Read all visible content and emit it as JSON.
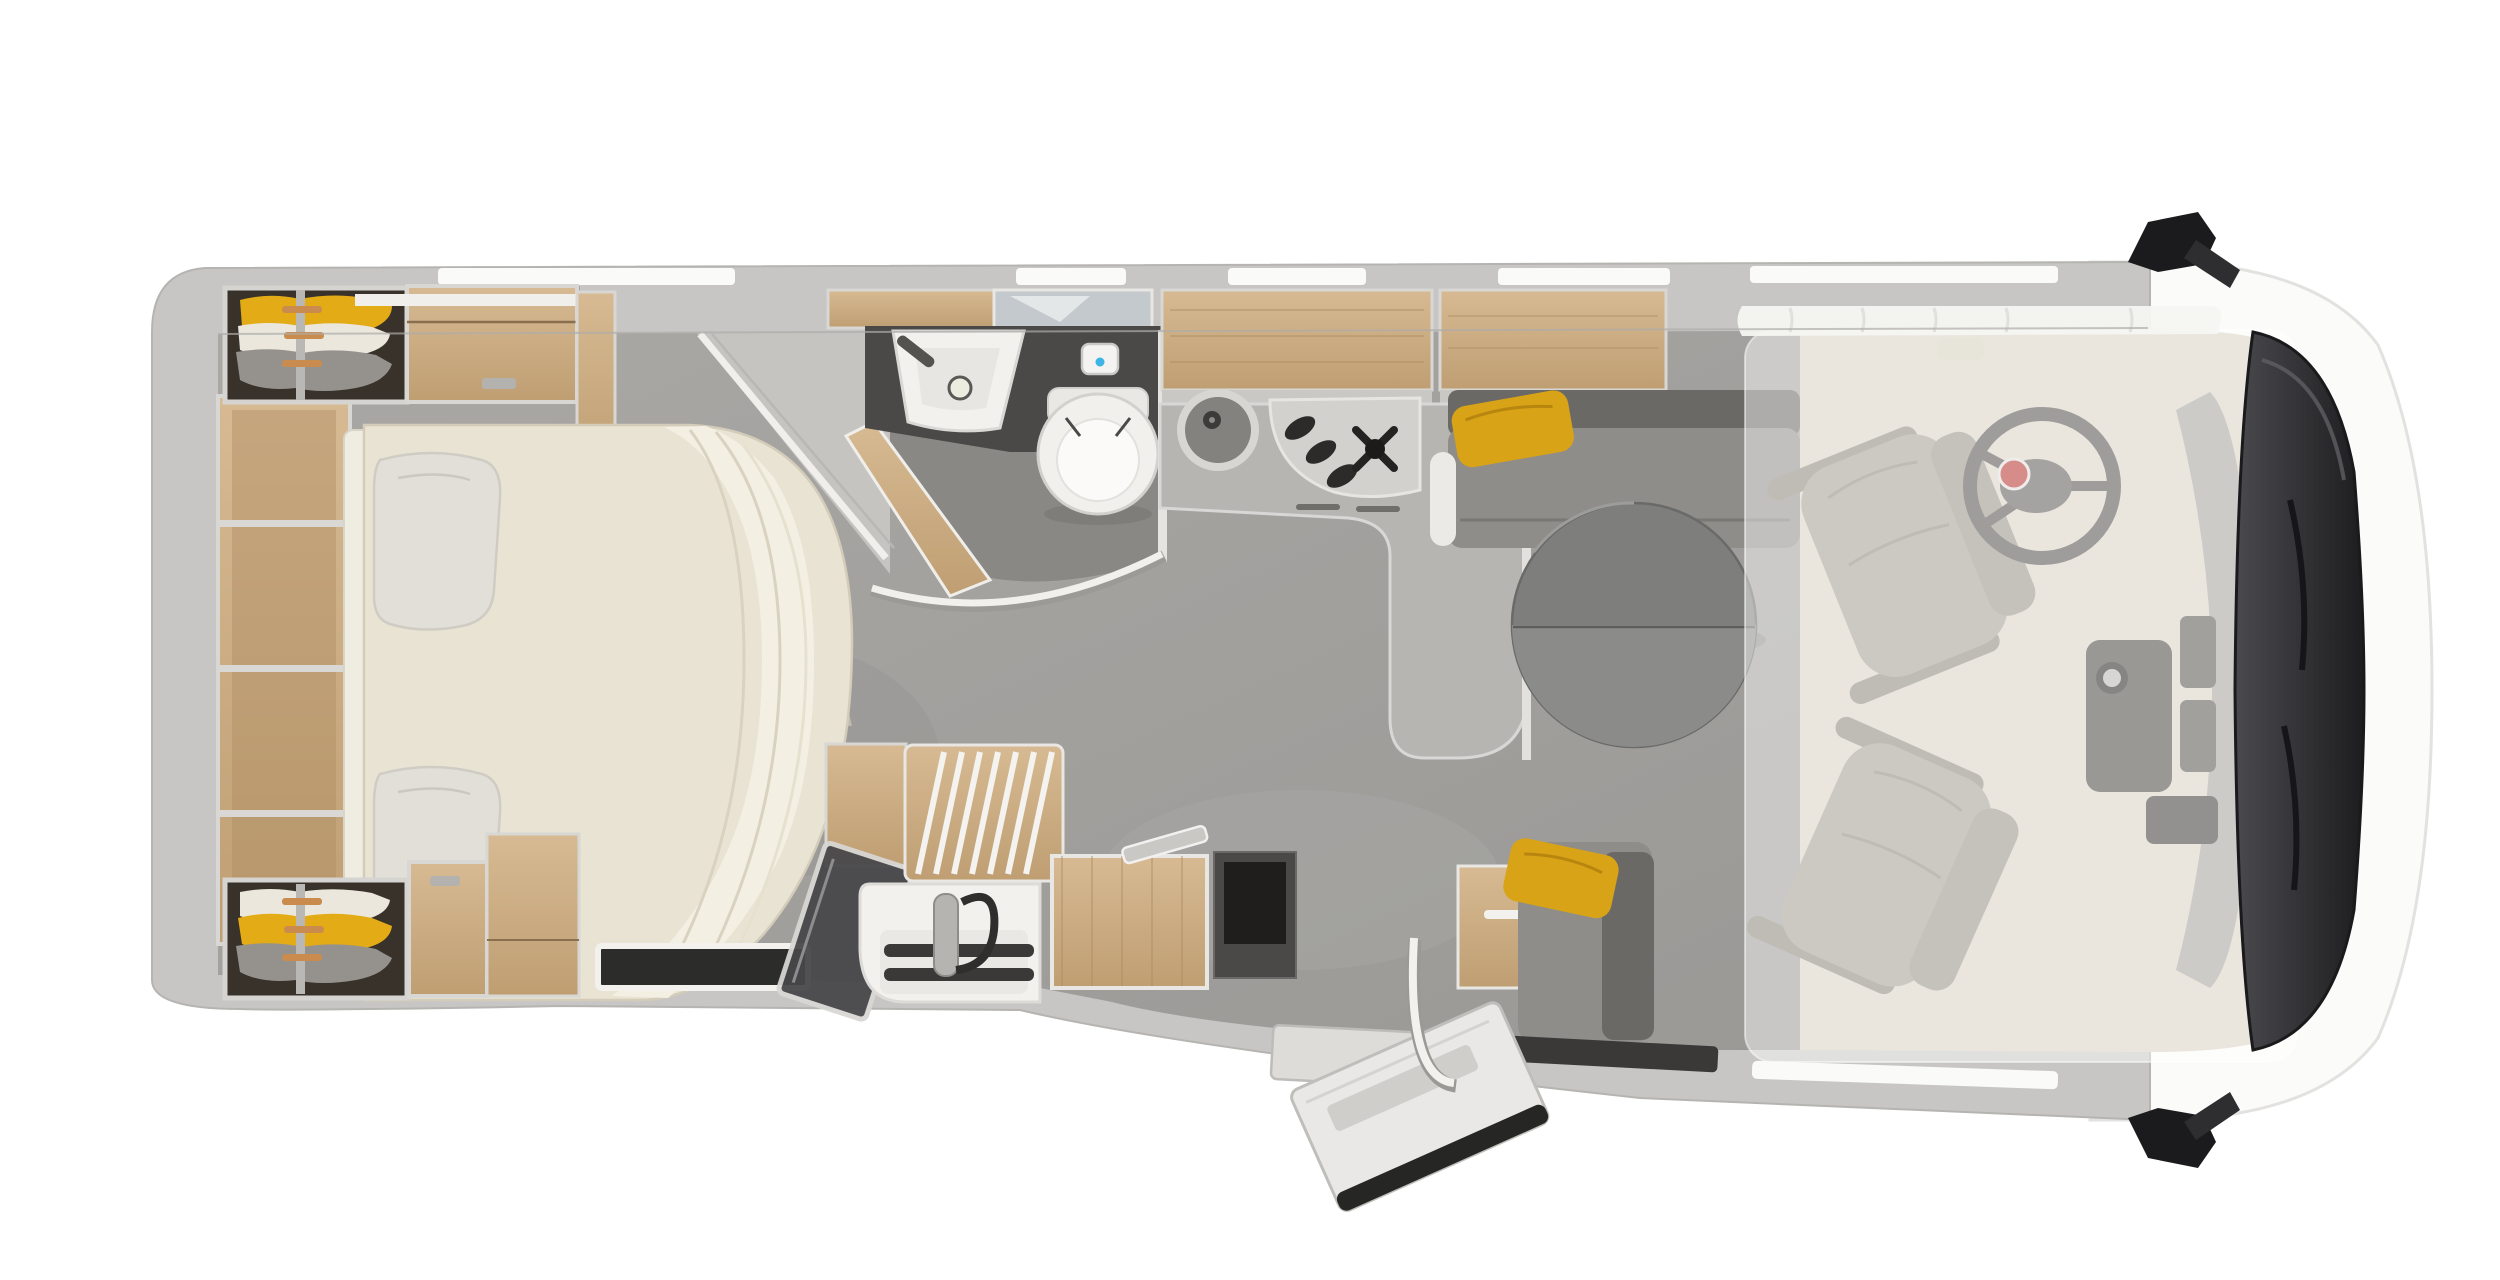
{
  "scene": {
    "label": "Motorhome floor plan - top view 3D render",
    "view": "top-down",
    "vehicle_front": "right"
  },
  "areas": {
    "bedroom": "rear island bed with wardrobes",
    "bathroom": "washroom with basin, mirror and toilet",
    "shower": "corner shower",
    "kitchen": "kitchenette with round sink and 3-burner hob",
    "galley": "lower galley block with sink, slatted shelf and worktop",
    "dinette": "L-lounge with round table and yellow cushions",
    "cab": "driver cab with two swivel seats",
    "drop_down_bed": "semi-transparent drop-down bed over cab",
    "entry_door": "open entrance door",
    "wardrobes": "open wardrobes with hanging clothes (yellow, white, grey)"
  },
  "colors": {
    "background": "#ffffff",
    "wall": "#c7c6c4",
    "wallEdge": "#aeadaa",
    "floor": "#a3a19e",
    "bathFloor": "#8a8885",
    "cabFloor": "#d9d2c3",
    "cream": "#dfd8c9",
    "bed": "#e9e3d3",
    "bedThrow": "#f3efe3",
    "pillow": "#e2dfd8",
    "wood": "#c9aa81",
    "woodLight": "#d9bd97",
    "woodDark": "#b08e63",
    "darkWardrobe": "#39322a",
    "clothesYellow": "#e3ab15",
    "clothesWhite": "#ebe7dd",
    "clothesGray": "#95928e",
    "sofa": "#8f8d89",
    "sofaDark": "#6b6966",
    "cushionYellow": "#d8a317",
    "table": "#7e7e7c",
    "tableLight": "#8b8b89",
    "counter": "#b7b5b2",
    "counterDark": "#4b4947",
    "sinkBowl": "#84827f",
    "hobFace": "#d2d1ce",
    "burnerDark": "#2c2b29",
    "white": "#f2f1ee",
    "toiletWhite": "#f1f0ed",
    "blueDot": "#3cb4e5",
    "seatGray": "#a39d92",
    "seatShadow": "#8b8478",
    "steering": "#504e4b",
    "fiatRed": "#b43129",
    "windshield": "#2f2f31",
    "mirrorBlack": "#1b1b1d",
    "glassDark": "#47474a",
    "overlay": "rgba(255,255,255,0.45)"
  }
}
